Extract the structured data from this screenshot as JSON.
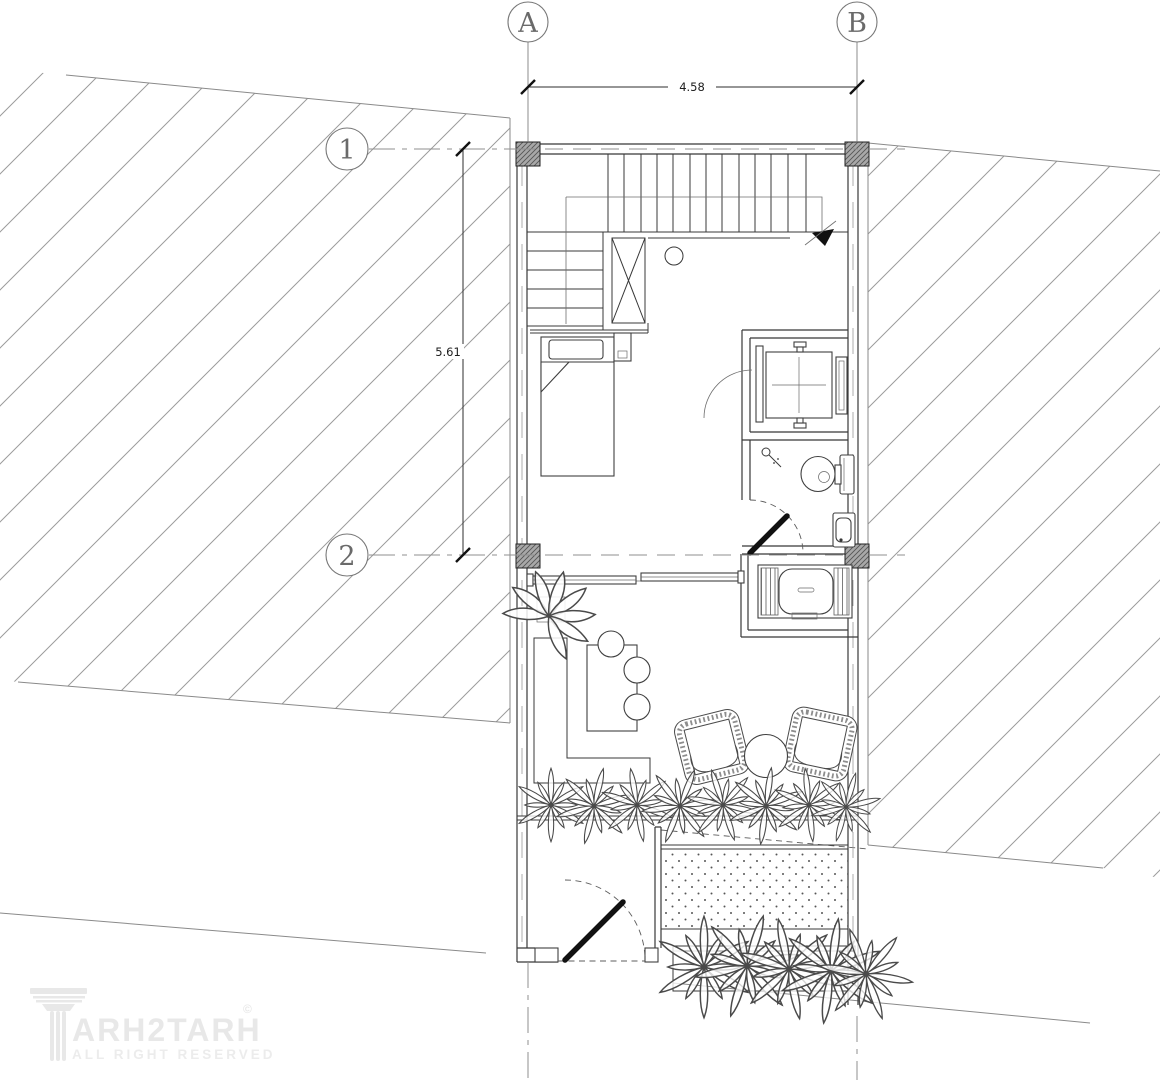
{
  "grid": {
    "columns": [
      {
        "label": "A"
      },
      {
        "label": "B"
      }
    ],
    "rows": [
      {
        "label": "1"
      },
      {
        "label": "2"
      }
    ]
  },
  "dimensions": {
    "horizontal": "4.58",
    "vertical": "5.61"
  },
  "watermark": {
    "brand": "ARH2TARH",
    "copyright": "©",
    "tagline": "ALL RIGHT RESERVED"
  },
  "colors": {
    "paper": "#ffffff",
    "ink": "#383838",
    "grid_line": "#8f8f8f",
    "site_hatch": "#9c9c9c",
    "column_fill": "#a8a8a8",
    "watermark": "#e8e8e8"
  }
}
